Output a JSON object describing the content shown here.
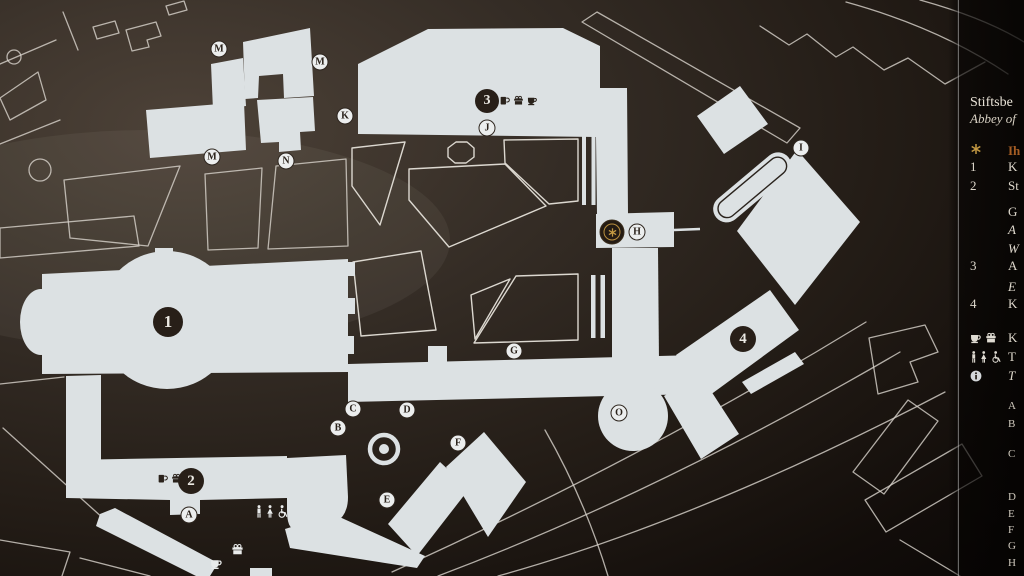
{
  "colors": {
    "background_dark": "#2b231d",
    "building_fill": "#dce1e3",
    "outline": "#d9d5cd",
    "marker_dark": "#281f18",
    "gold": "#c09540",
    "orange_text": "#a55d24",
    "panel_black": "#0b0706"
  },
  "legend": {
    "title": "Stiftsbe",
    "subtitle": "Abbey of",
    "you_are_here": {
      "icon": "star-icon",
      "label": "Ih",
      "y": 143
    },
    "numbered": [
      {
        "num": "1",
        "label": "K",
        "y": 160,
        "sublines": []
      },
      {
        "num": "2",
        "label": "St",
        "y": 179,
        "sublines": [
          {
            "t": "G",
            "i": false,
            "y": 204
          },
          {
            "t": "A",
            "i": true,
            "y": 222
          },
          {
            "t": "W",
            "i": true,
            "y": 241
          }
        ]
      },
      {
        "num": "3",
        "label": "A",
        "y": 259,
        "sublines": [
          {
            "t": "E",
            "i": true,
            "y": 279
          }
        ]
      },
      {
        "num": "4",
        "label": "K",
        "y": 297,
        "sublines": []
      }
    ],
    "facilities": [
      {
        "icons": [
          "cup-icon",
          "gift-icon"
        ],
        "label": "K",
        "italic": false,
        "y": 331
      },
      {
        "icons": [
          "man-icon",
          "woman-icon",
          "wheelchair-icon"
        ],
        "label": "T",
        "italic": false,
        "y": 350
      },
      {
        "icons": [
          "info-icon"
        ],
        "label": "T",
        "italic": true,
        "y": 369
      }
    ],
    "letter_index": [
      {
        "l": "A",
        "y": 400
      },
      {
        "l": "B",
        "y": 418
      },
      {
        "l": "C",
        "y": 448
      },
      {
        "l": "D",
        "y": 491
      },
      {
        "l": "E",
        "y": 508
      },
      {
        "l": "F",
        "y": 524
      },
      {
        "l": "G",
        "y": 540
      },
      {
        "l": "H",
        "y": 557
      }
    ]
  },
  "map": {
    "number_markers": [
      {
        "label": "1",
        "x": 168,
        "y": 322,
        "size": 30,
        "font": 17
      },
      {
        "label": "2",
        "x": 191,
        "y": 481,
        "size": 26,
        "font": 15
      },
      {
        "label": "3",
        "x": 487,
        "y": 101,
        "size": 24,
        "font": 14
      },
      {
        "label": "4",
        "x": 743,
        "y": 339,
        "size": 26,
        "font": 15
      }
    ],
    "letter_markers": [
      {
        "label": "M",
        "x": 219,
        "y": 49
      },
      {
        "label": "M",
        "x": 320,
        "y": 62
      },
      {
        "label": "K",
        "x": 345,
        "y": 116
      },
      {
        "label": "J",
        "x": 487,
        "y": 128
      },
      {
        "label": "M",
        "x": 212,
        "y": 157
      },
      {
        "label": "N",
        "x": 286,
        "y": 161
      },
      {
        "label": "I",
        "x": 801,
        "y": 148
      },
      {
        "label": "H",
        "x": 637,
        "y": 232
      },
      {
        "label": "G",
        "x": 514,
        "y": 351
      },
      {
        "label": "O",
        "x": 619,
        "y": 413
      },
      {
        "label": "C",
        "x": 353,
        "y": 409
      },
      {
        "label": "D",
        "x": 407,
        "y": 410
      },
      {
        "label": "B",
        "x": 338,
        "y": 428
      },
      {
        "label": "F",
        "x": 458,
        "y": 443
      },
      {
        "label": "E",
        "x": 387,
        "y": 500
      },
      {
        "label": "A",
        "x": 189,
        "y": 515
      }
    ],
    "you_are_here_marker": {
      "x": 612,
      "y": 232,
      "icon": "star-icon"
    },
    "icon_groups": [
      {
        "x": 499,
        "y": 95,
        "tone": "dark",
        "icons": [
          "mug-icon",
          "gift-icon",
          "cup-icon"
        ]
      },
      {
        "x": 157,
        "y": 473,
        "tone": "dark",
        "icons": [
          "mug-icon",
          "gift-icon"
        ]
      },
      {
        "x": 255,
        "y": 505,
        "tone": "light",
        "icons": [
          "man-icon",
          "woman-icon",
          "wheelchair-icon"
        ]
      },
      {
        "x": 231,
        "y": 543,
        "tone": "light",
        "icons": [
          "gift-icon"
        ]
      },
      {
        "x": 210,
        "y": 557,
        "tone": "light",
        "icons": [
          "cup-icon"
        ]
      }
    ]
  }
}
